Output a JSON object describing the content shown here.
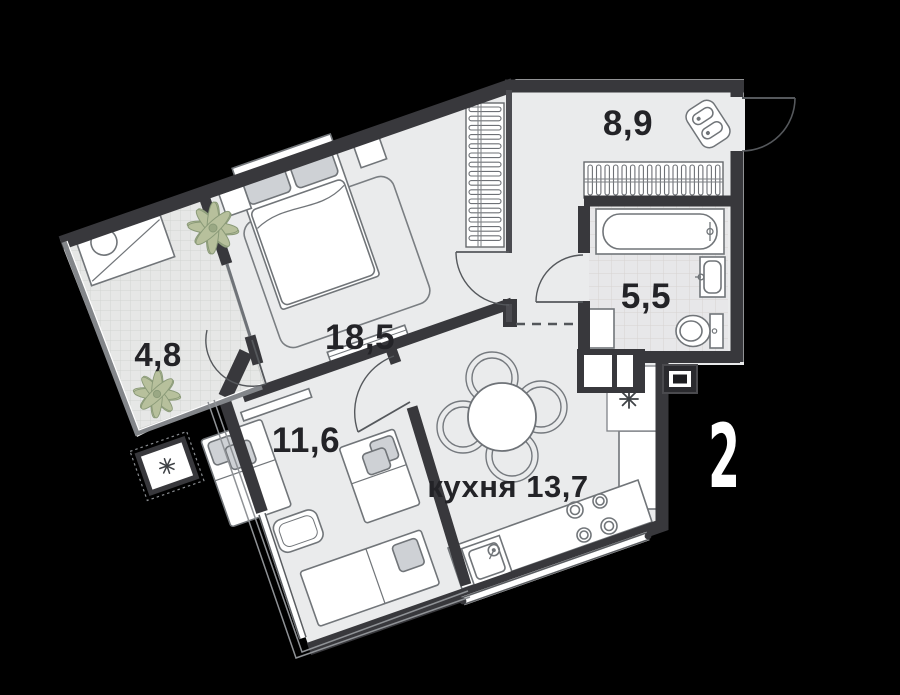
{
  "page": {
    "background": "#000000"
  },
  "plan": {
    "apartment_number": "2",
    "rooms": [
      {
        "id": "hallway",
        "label": "8,9"
      },
      {
        "id": "bathroom",
        "label": "5,5"
      },
      {
        "id": "bedroom",
        "label": "18,5"
      },
      {
        "id": "balcony",
        "label": "4,8"
      },
      {
        "id": "children-room",
        "label": "11,6"
      },
      {
        "id": "kitchen",
        "label": "кухня 13,7"
      }
    ],
    "icons": [
      "double-bed-icon",
      "single-bed-icon",
      "bathtub-icon",
      "washbasin-icon",
      "toilet-icon",
      "washer-icon",
      "wardrobe-icon",
      "shoe-cabinet-icon",
      "dining-table-icon",
      "chair-icon",
      "kitchen-sink-icon",
      "stove-icon",
      "plant-icon",
      "snowflake-icon",
      "ac-unit-icon",
      "electrical-panel-icon",
      "desk-icon",
      "stool-icon",
      "rug-icon",
      "shelf-icon",
      "entry-door-icon"
    ],
    "colors": {
      "background": "#000000",
      "floor": "#eaebec",
      "walls": "#38383c",
      "thin_wall": "#4b4b50",
      "tile_bath_line": "#d7d3d1",
      "tile_balcony_line": "#d2d4d2",
      "furniture_line": "#717579",
      "pillow_fill": "#ced1d5",
      "plant_fill": "#b7c09c",
      "plant_line": "#8a9a78",
      "label_text": "#232327",
      "apartment_digit": "#ffffff"
    }
  }
}
